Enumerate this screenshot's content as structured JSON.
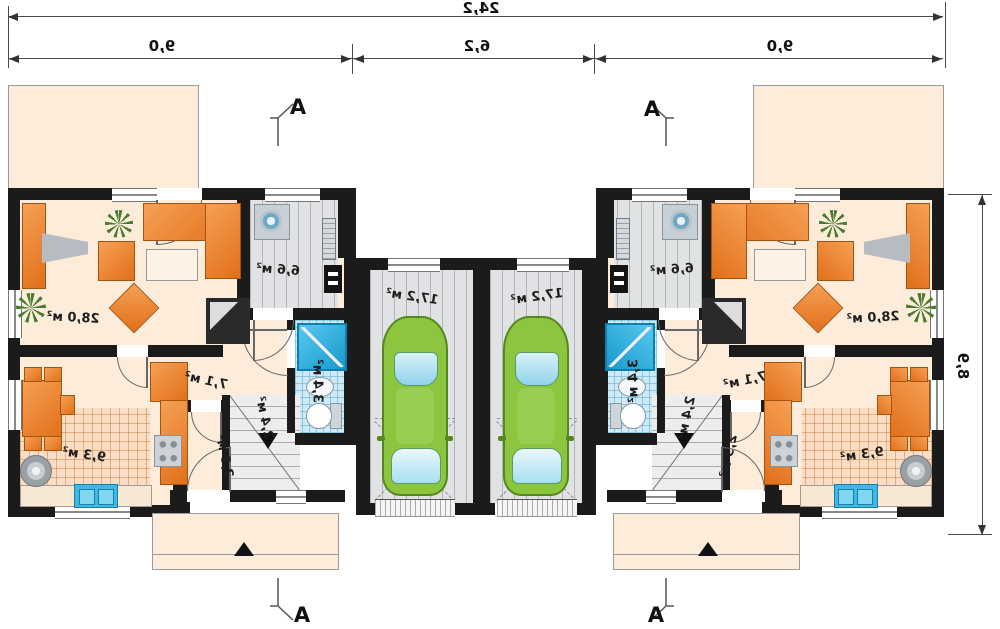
{
  "plan": {
    "dims": {
      "total": "24,2",
      "left": "9,0",
      "middle": "6,2",
      "right": "9,0",
      "depth": "8,9"
    },
    "section_marker": "A",
    "rooms_left": {
      "living": "28,0 м²",
      "vestibule": "6,6 м²",
      "bathroom": "3,4 м²",
      "hall": "7,1 м²",
      "stairs": "2,4 м²",
      "wc": "2,9 м²",
      "kitchen": "9,3 м²",
      "garage": "17,2 м²"
    },
    "rooms_right": {
      "living": "28,0 м²",
      "vestibule": "6,6 м²",
      "bathroom": "3,4 м²",
      "hall": "7,1 м²",
      "stairs": "2,4 м²",
      "wc": "2,9 м²",
      "kitchen": "9,3 м²",
      "garage": "17,2 м²"
    },
    "colors": {
      "wall": "#1b1b1b",
      "floor": "#fcecd9",
      "furniture_orange": "#e1701a",
      "tile_blue": "#cdeaf6",
      "car_green": "#8cc63f",
      "garage_gray": "#e0e2e4"
    },
    "note_mirrored": "all text rendered horizontally mirrored"
  }
}
